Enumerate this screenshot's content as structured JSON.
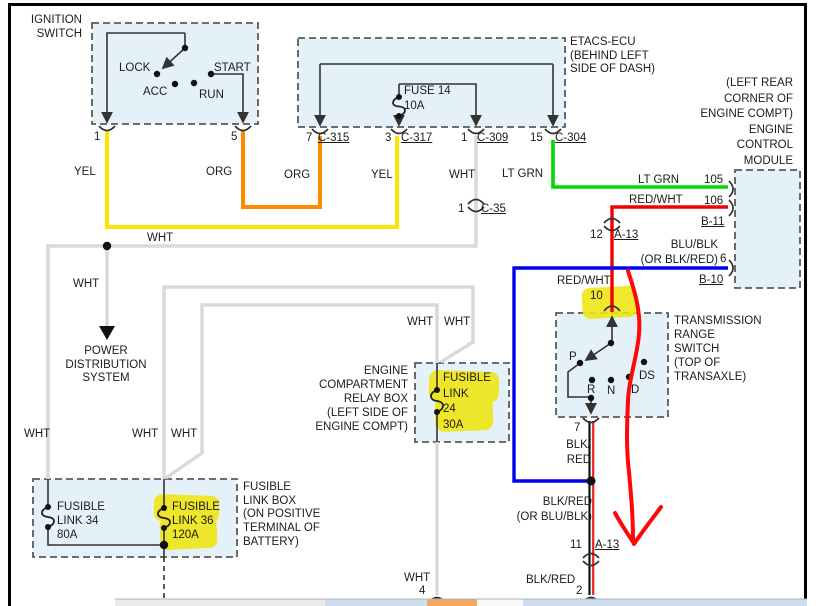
{
  "colors": {
    "box_fill": "#e4f1f9",
    "box_border": "#5a5a5a",
    "yellow_wire": "#ffe400",
    "orange_wire": "#ff8c00",
    "white_wire": "#d9d9d9",
    "green_wire": "#00d800",
    "red_wire": "#f00000",
    "blue_wire": "#0000ea",
    "black_red_pair": [
      "#111111",
      "#e82222"
    ],
    "highlighter": "#efe40e",
    "annotation_red": "#ff0808"
  },
  "boxes": {
    "ignition_switch": {
      "title": "IGNITION\nSWITCH",
      "positions": {
        "lock": "LOCK",
        "acc": "ACC",
        "run": "RUN",
        "start": "START"
      },
      "pins": {
        "p1": "1",
        "p5": "5"
      }
    },
    "etacs_ecu": {
      "title": "ETACS-ECU\n(BEHIND LEFT\nSIDE OF DASH)",
      "fuse": "FUSE 14\n10A",
      "pins": {
        "p7": "7",
        "c315": "C-315",
        "p3": "3",
        "c317": "C-317",
        "p1": "1",
        "c309": "C-309",
        "p15": "15",
        "c304": "C-304"
      }
    },
    "engine_control_module": {
      "title": "(LEFT REAR\nCORNER OF\nENGINE COMPT)\nENGINE\nCONTROL\nMODULE",
      "pins": {
        "p105": "105",
        "p106": "106",
        "b11": "B-11",
        "p6": "6",
        "b10": "B-10"
      }
    },
    "transmission_range_switch": {
      "title": "TRANSMISSION\nRANGE\nSWITCH\n(TOP OF\nTRANSAXLE)",
      "positions": {
        "p": "P",
        "r": "R",
        "n": "N",
        "d": "D",
        "ds": "DS"
      },
      "pins": {
        "p10": "10",
        "p7": "7"
      }
    },
    "relay_box": {
      "title": "ENGINE\nCOMPARTMENT\nRELAY BOX\n(LEFT SIDE OF\nENGINE COMPT)",
      "fuse": "FUSIBLE\nLINK\n24\n30A"
    },
    "fusible_link_box": {
      "title": "FUSIBLE\nLINK BOX\n(ON POSITIVE\nTERMINAL OF\nBATTERY)",
      "link34": "FUSIBLE\nLINK 34\n80A",
      "link36": "FUSIBLE\nLINK 36\n120A"
    }
  },
  "connectors": {
    "c35_pin": "1",
    "c35_name": "C-35",
    "a13_upper_pin": "12",
    "a13_upper_name": "A-13",
    "a13_lower_pin": "11",
    "a13_lower_name": "A-13",
    "bottom_wht_pin": "4",
    "bottom_blkred_pin": "2"
  },
  "wire_labels": {
    "yel_left": "YEL",
    "org_left": "ORG",
    "org_right": "ORG",
    "yel_right": "YEL",
    "wht_top": "WHT",
    "lt_grn_left": "LT GRN",
    "lt_grn_right": "LT GRN",
    "red_wht_upper": "RED/WHT",
    "red_wht_lower": "RED/WHT",
    "blu_blk": "BLU/BLK\n(OR BLK/RED)",
    "pin6": "6",
    "blk_red_upper": "BLK/\nRED",
    "blk_red_mid": "BLK/RED\n(OR BLU/BLK)",
    "blk_red_lower": "BLK/RED",
    "wht_bus": "WHT",
    "wht_branch": "WHT",
    "wht_relay_left": "WHT",
    "wht_relay_right": "WHT",
    "wht_fl_left": "WHT",
    "wht_fl_mid": "WHT",
    "wht_fl_right": "WHT",
    "wht_bottom": "WHT"
  },
  "misc": {
    "power_distribution": "POWER\nDISTRIBUTION\nSYSTEM"
  }
}
